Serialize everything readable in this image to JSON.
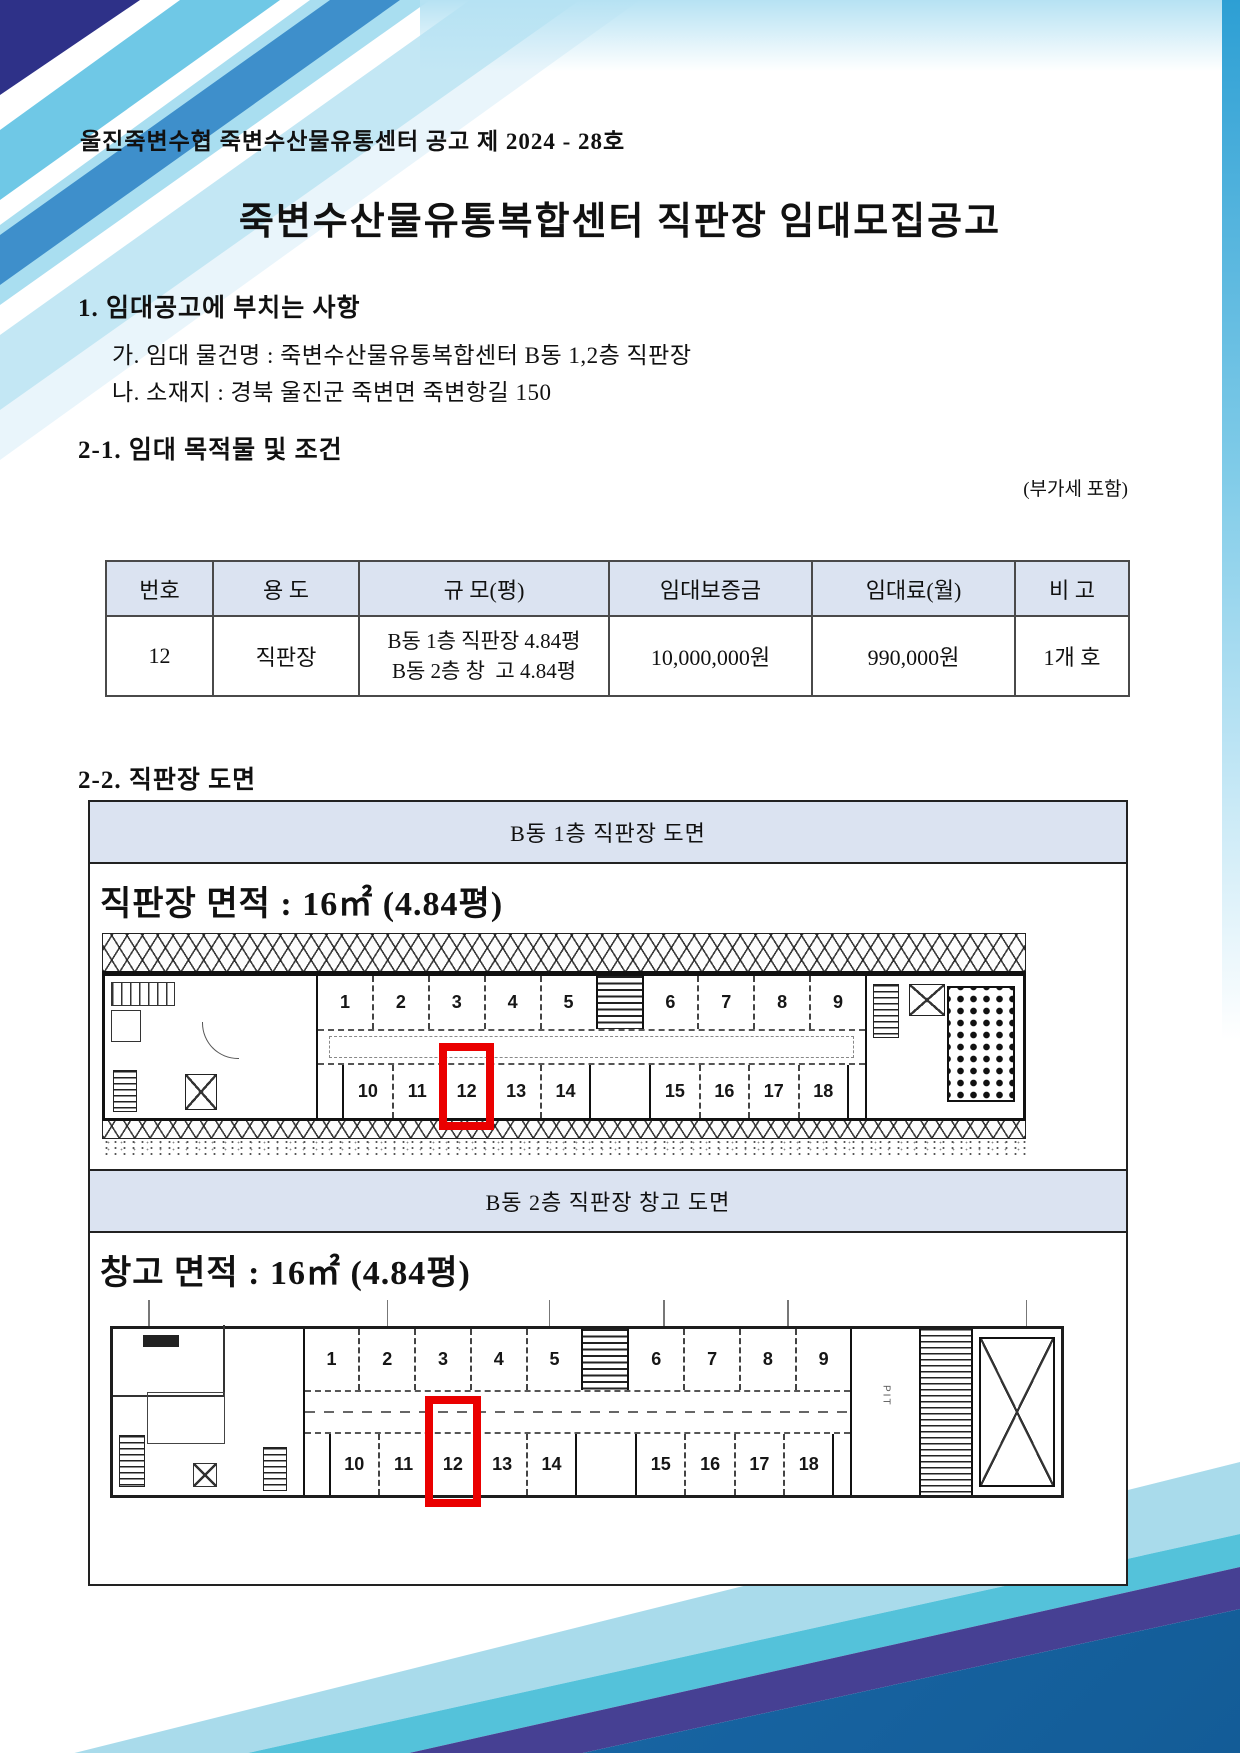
{
  "page": {
    "doc_no": "울진죽변수협 죽변수산물유통센터 공고 제 2024 - 28호",
    "title": "죽변수산물유통복합센터 직판장 임대모집공고"
  },
  "section1": {
    "heading": "1. 임대공고에 부치는 사항",
    "items": [
      {
        "label": "가. 임대 물건명 : 죽변수산물유통복합센터 B동 1,2층 직판장"
      },
      {
        "label": "나. 소재지 : 경북 울진군 죽변면 죽변항길 150"
      }
    ]
  },
  "section2_1": {
    "heading": "2-1. 임대 목적물 및 조건",
    "vat_note": "(부가세 포함)",
    "table": {
      "headers": [
        "번호",
        "용 도",
        "규 모(평)",
        "임대보증금",
        "임대료(월)",
        "비 고"
      ],
      "row": {
        "no": "12",
        "use": "직판장",
        "size_line1": "B동 1층 직판장 4.84평",
        "size_line2": "B동 2층 창  고 4.84평",
        "deposit": "10,000,000원",
        "monthly_rent": "990,000원",
        "note": "1개 호"
      }
    }
  },
  "section2_2": {
    "heading": "2-2. 직판장 도면",
    "floor1": {
      "band_title": "B동 1층 직판장 도면",
      "area_label": "직판장 면적 : 16㎡ (4.84평)",
      "stalls_top": [
        "1",
        "2",
        "3",
        "4",
        "5",
        "6",
        "7",
        "8",
        "9"
      ],
      "stalls_bottom": [
        "10",
        "11",
        "12",
        "13",
        "14",
        "15",
        "16",
        "17",
        "18"
      ],
      "highlighted_stall": "12"
    },
    "floor2": {
      "band_title": "B동 2층 직판장 창고 도면",
      "area_label": "창고 면적 : 16㎡ (4.84평)",
      "stalls_top": [
        "1",
        "2",
        "3",
        "4",
        "5",
        "6",
        "7",
        "8",
        "9"
      ],
      "stalls_bottom": [
        "10",
        "11",
        "12",
        "13",
        "14",
        "15",
        "16",
        "17",
        "18"
      ],
      "pit_label": "PIT",
      "highlighted_stall": "12"
    }
  },
  "colors": {
    "band_bg": "#dbe3f1",
    "highlight_red": "#ea0000",
    "wave_light_blue": "#a9dbeb",
    "wave_cyan": "#54c2da",
    "wave_purple": "#464093",
    "wave_blue": "#1d6fb1",
    "wave_navy": "#2e3188"
  }
}
